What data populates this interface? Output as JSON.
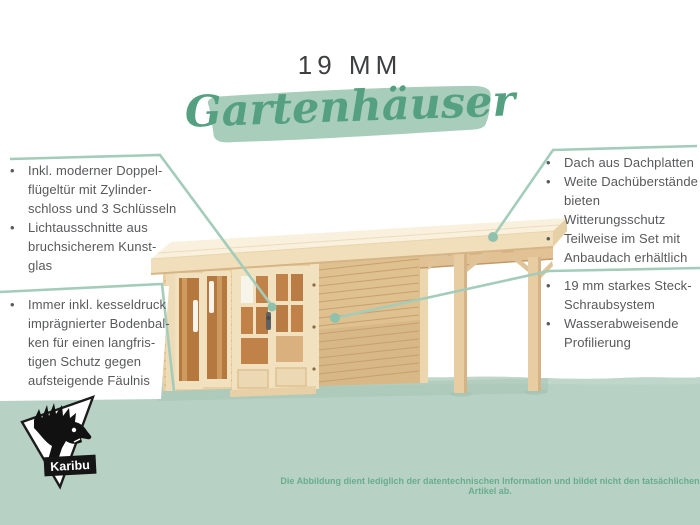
{
  "header": {
    "size_label": "19 MM",
    "script_title": "Gartenhäuser"
  },
  "ui": {
    "bullet": "•"
  },
  "callouts": {
    "left_top": {
      "items": [
        {
          "text": "Inkl. moderner Doppel-\nflügeltür mit Zylinder-\nschloss und 3 Schlüsseln"
        },
        {
          "text": "Lichtausschnitte aus\nbruchsicherem Kunst-\nglas"
        }
      ]
    },
    "left_bottom": {
      "items": [
        {
          "text": "Immer inkl. kesseldruck\nimprägnierter Bodenbal-\nken für einen langfris-\ntigen Schutz gegen\naufsteigende Fäulnis"
        }
      ]
    },
    "right_top": {
      "items": [
        {
          "text": "Dach aus Dachplatten"
        },
        {
          "text": "Weite Dachüberstände\nbieten Witterungsschutz"
        },
        {
          "text": "Teilweise im Set mit\nAnbaudach erhältlich"
        }
      ]
    },
    "right_bottom": {
      "items": [
        {
          "text": "19 mm starkes Steck-\nSchraubsystem"
        },
        {
          "text": "Wasserabweisende\nProfilierung"
        }
      ]
    }
  },
  "footer": {
    "disclaimer": "Die Abbildung dient lediglich der datentechnischen Information und bildet nicht den tatsächlichen Artikel ab.",
    "logo_label": "Karibu"
  },
  "colors": {
    "script_green": "#55a081",
    "brush_green": "#a8cdbb",
    "callout_line": "#a4ccba",
    "callout_dot": "#8fc2ac",
    "body_text": "#58595b",
    "title_text": "#3e3f41",
    "disclaimer_text": "#68ad8d",
    "ground_green": "#b7d2c4",
    "wood_frame": "#f2e1bf",
    "wood_wall": "#e9cfa3",
    "wood_side": "#dfc08f",
    "wood_glass": "#b5783f",
    "roof_top": "#f9f1de"
  }
}
